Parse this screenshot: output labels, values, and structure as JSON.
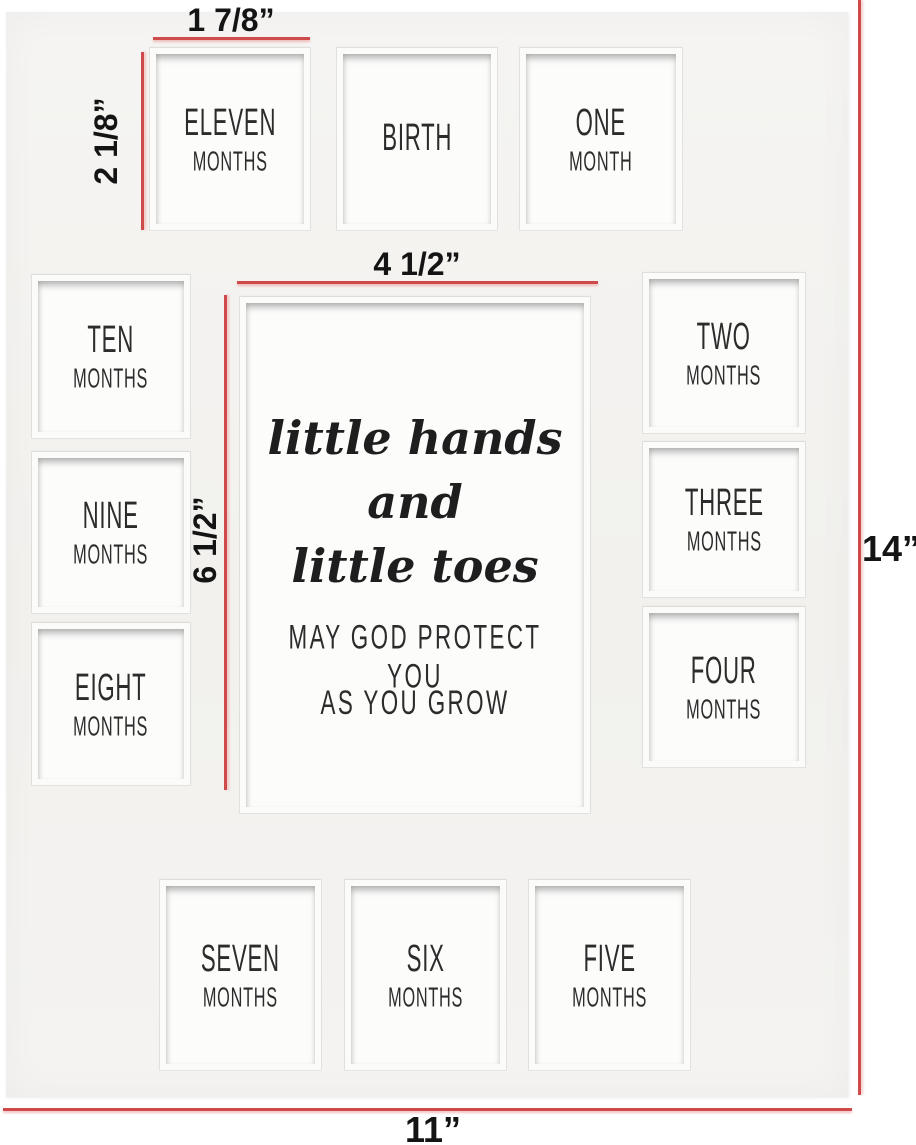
{
  "colors": {
    "background": "#ffffff",
    "mat": "#f3f2f0",
    "opening": "#fcfcfb",
    "dimension_red": "#cf4a4a",
    "ink": "#2c2c2c"
  },
  "dimension_labels": {
    "small_width": "1 7/8”",
    "small_height": "2 1/8”",
    "center_width": "4 1/2”",
    "center_height": "6 1/2”",
    "overall_height": "14”",
    "overall_width": "11”"
  },
  "openings": [
    {
      "id": "eleven-months",
      "line1": "ELEVEN",
      "line2": "MONTHS"
    },
    {
      "id": "birth",
      "line1": "BIRTH",
      "line2": ""
    },
    {
      "id": "one-month",
      "line1": "ONE",
      "line2": "MONTH"
    },
    {
      "id": "ten-months",
      "line1": "TEN",
      "line2": "MONTHS"
    },
    {
      "id": "two-months",
      "line1": "TWO",
      "line2": "MONTHS"
    },
    {
      "id": "nine-months",
      "line1": "NINE",
      "line2": "MONTHS"
    },
    {
      "id": "three-months",
      "line1": "THREE",
      "line2": "MONTHS"
    },
    {
      "id": "eight-months",
      "line1": "EIGHT",
      "line2": "MONTHS"
    },
    {
      "id": "four-months",
      "line1": "FOUR",
      "line2": "MONTHS"
    },
    {
      "id": "seven-months",
      "line1": "SEVEN",
      "line2": "MONTHS"
    },
    {
      "id": "six-months",
      "line1": "SIX",
      "line2": "MONTHS"
    },
    {
      "id": "five-months",
      "line1": "FIVE",
      "line2": "MONTHS"
    }
  ],
  "center_opening": {
    "script_line1": "little hands",
    "script_line2": "and",
    "script_line3": "little toes",
    "caption_line1": "MAY GOD PROTECT YOU",
    "caption_line2": "AS YOU GROW"
  }
}
